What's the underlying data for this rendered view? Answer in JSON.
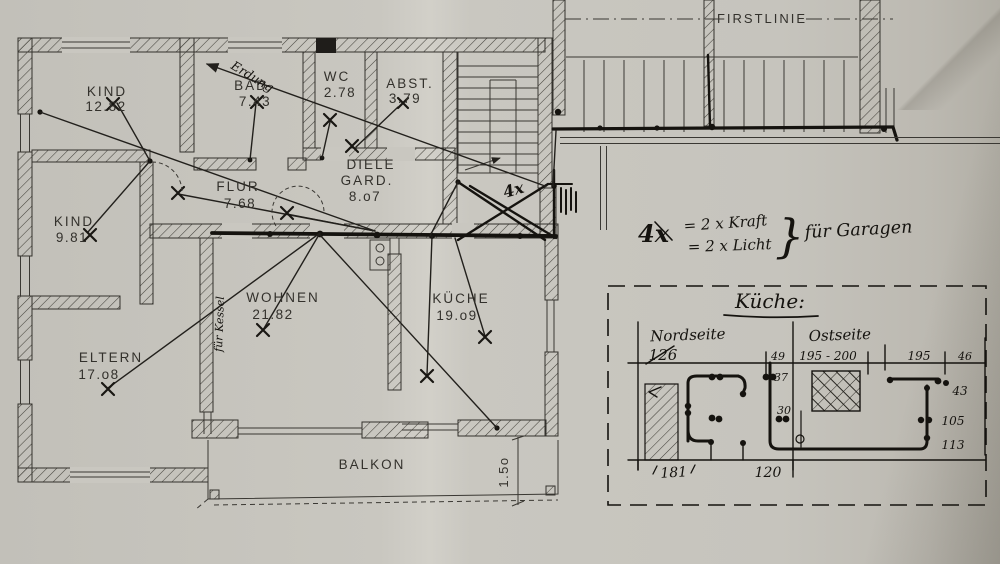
{
  "colors": {
    "paper": "#c7c5be",
    "ink": "#33312c",
    "pen": "#15130f"
  },
  "plan": {
    "rooms": [
      {
        "id": "kind1",
        "name": "KIND",
        "area": "12.82"
      },
      {
        "id": "bad",
        "name": "BAD",
        "area": "7.43"
      },
      {
        "id": "wc",
        "name": "WC",
        "area": "2.78"
      },
      {
        "id": "abst",
        "name": "ABST.",
        "area": "3.79"
      },
      {
        "id": "flur",
        "name": "FLUR",
        "area": "7.68"
      },
      {
        "id": "diele",
        "name": "DIELE",
        "name2": "GARD.",
        "area": "8.o7"
      },
      {
        "id": "kind2",
        "name": "KIND",
        "area": "9.81"
      },
      {
        "id": "wohnen",
        "name": "WOHNEN",
        "area": "21.82"
      },
      {
        "id": "kueche",
        "name": "KÜCHE",
        "area": "19.o9"
      },
      {
        "id": "eltern",
        "name": "ELTERN",
        "area": "17.o8"
      },
      {
        "id": "balkon",
        "name": "BALKON"
      }
    ],
    "ridge_label": "FIRSTLINIE",
    "balcony_dim": "1.5o"
  },
  "handwritten": {
    "erdung": "Erdung",
    "kessel": "für Kessel",
    "stair_mark": "4x",
    "garage_note": {
      "lhs": "4x",
      "line1": "= 2 x Kraft",
      "line2": "= 2 x Licht",
      "brace": "}",
      "rhs": "für Garagen"
    }
  },
  "kitchen_sketch": {
    "title": "Küche:",
    "sections": [
      {
        "label": "Nordseite"
      },
      {
        "label": "Ostseite"
      }
    ],
    "dims": {
      "top": [
        "126",
        "49",
        "195 - 200",
        "195",
        "46"
      ],
      "north_side": [
        "37",
        "30"
      ],
      "east_side": [
        "43",
        "105",
        "113"
      ],
      "bottom": [
        "181",
        "120"
      ]
    }
  }
}
